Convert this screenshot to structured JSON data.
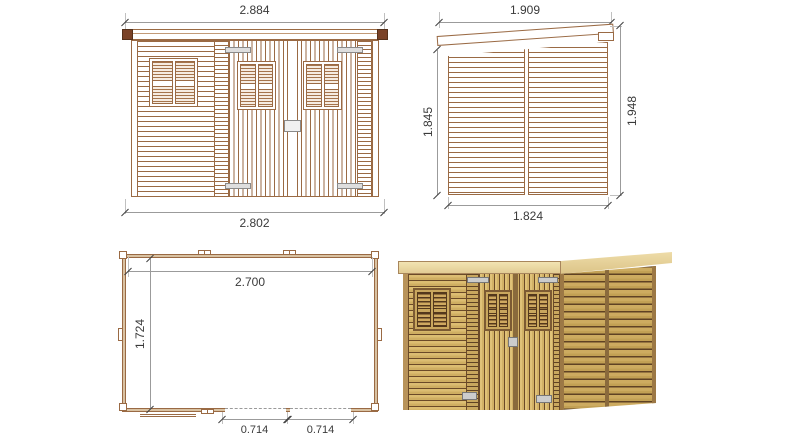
{
  "drawing_title": "garden shed technical drawing, four views",
  "views": {
    "front_elevation": {
      "dims": {
        "top": "2.884",
        "bottom": "2.802"
      }
    },
    "side_elevation": {
      "dims": {
        "top": "1.909",
        "left": "1.845",
        "right": "1.948",
        "bottom": "1.824"
      }
    },
    "floor_plan": {
      "dims": {
        "inner_width": "2.700",
        "inner_depth": "1.724",
        "door_left": "0.714",
        "door_right": "0.714"
      }
    },
    "rendered_view": {}
  },
  "colors": {
    "line_brown": "#9a6a44",
    "roof_cap_brown": "#7a4227",
    "dimension_gray": "#9b9b9b",
    "text_gray": "#3a3a3a",
    "wood_light": "#dcbd72",
    "wood_shadow": "#6b4a28",
    "hardware_gray": "#cccccc",
    "background": "#ffffff"
  }
}
